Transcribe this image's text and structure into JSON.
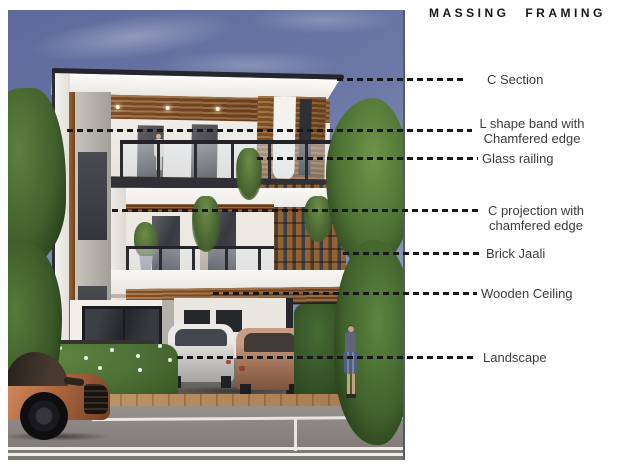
{
  "title": "MASSING FRAMING",
  "annotations": [
    {
      "id": "c-section",
      "label": "C Section"
    },
    {
      "id": "l-shape-band",
      "label": "L shape band with\nChamfered edge"
    },
    {
      "id": "glass-railing",
      "label": "Glass railing"
    },
    {
      "id": "c-projection",
      "label": "C projection with\nchamfered edge"
    },
    {
      "id": "brick-jaali",
      "label": "Brick Jaali"
    },
    {
      "id": "wooden-ceiling",
      "label": "Wooden Ceiling"
    },
    {
      "id": "landscape",
      "label": "Landscape"
    }
  ],
  "colors": {
    "title_text": "#17171a",
    "label_text": "#3c3c3c",
    "leader_dash": "#18181a",
    "sky": "#6b77a5",
    "foliage": "#4c6c34",
    "wood": "#8a5a30",
    "white_wall": "#f0ede8",
    "dark_glass": "#393a40",
    "road": "#85807c",
    "copper_car": "#b16a42",
    "page_background": "#ffffff"
  }
}
